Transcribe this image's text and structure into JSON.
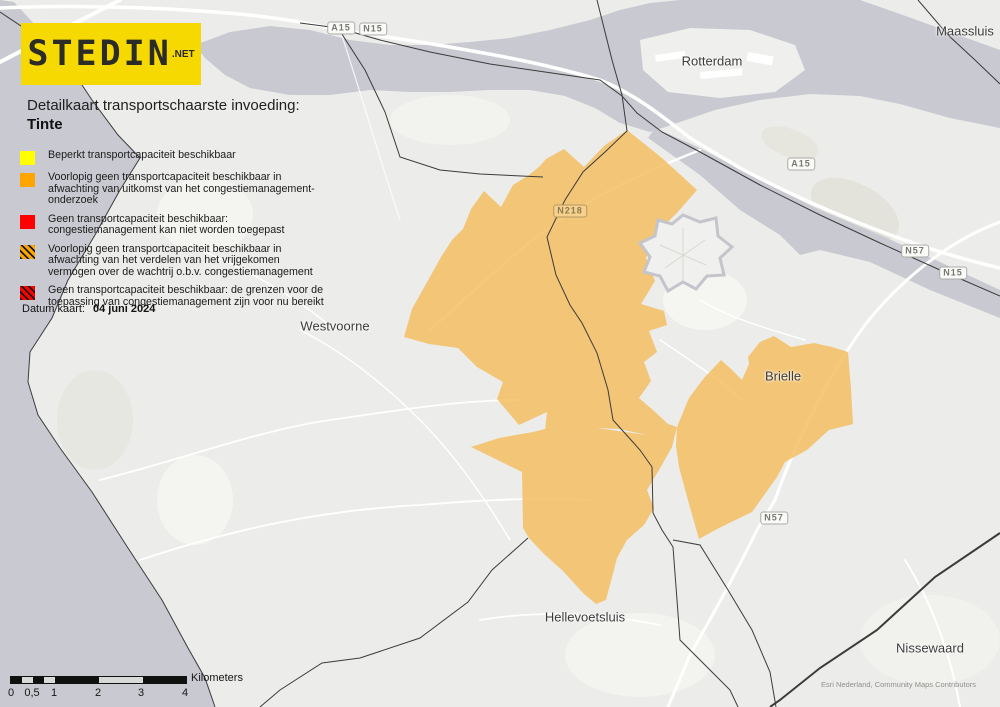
{
  "map": {
    "logo": {
      "text": "STEDIN",
      "suffix": ".NET"
    },
    "title_line1": "Detailkaart transportschaarste invoeding:",
    "title_line2": "Tinte",
    "legend": {
      "items": [
        {
          "style": "yellow",
          "label": "Beperkt transportcapaciteit beschikbaar"
        },
        {
          "style": "orange",
          "label": "Voorlopig geen transportcapaciteit beschikbaar in afwachting van uitkomst van het congestiemanagement-onderzoek"
        },
        {
          "style": "red",
          "label": "Geen transportcapaciteit beschikbaar: congestiemanagement kan niet worden toegepast"
        },
        {
          "style": "orange-hatch",
          "label": "Voorlopig geen transportcapaciteit beschikbaar in afwachting van het verdelen van het vrijgekomen vermogen over de wachtrij o.b.v. congestiemanagement"
        },
        {
          "style": "red-hatch",
          "label": "Geen transportcapaciteit beschikbaar: de grenzen voor de toepassing van congestiemanagement zijn voor nu bereikt"
        }
      ]
    },
    "date": {
      "label": "Datum kaart:",
      "value": "04 juni 2024"
    },
    "cities": [
      "Rotterdam",
      "Maassluis",
      "Westvoorne",
      "Brielle",
      "Hellevoetsluis",
      "Nissewaard"
    ],
    "road_shields": [
      "A15",
      "N15",
      "A15",
      "N57",
      "N15",
      "N218",
      "N57"
    ],
    "scalebar": {
      "ticks": [
        "0",
        "0,5",
        "1",
        "2",
        "3",
        "4"
      ],
      "unit": "Kilometers"
    },
    "attribution": "Esri Nederland, Community Maps Contributors",
    "colors": {
      "legend_yellow": "#FFFF00",
      "legend_orange": "#FFA500",
      "legend_red": "#FF0000",
      "map_orange_area": "#F3C46E",
      "water": "#C9C9D1",
      "land": "#ECECEA",
      "logo_yellow": "#F6D900"
    }
  }
}
